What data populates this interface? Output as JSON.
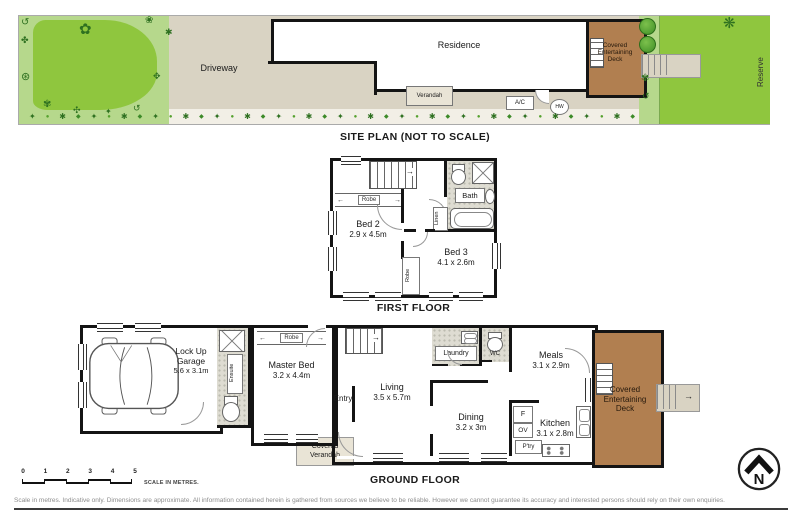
{
  "colors": {
    "lawn": "#8fc63e",
    "garden": "#b6d88c",
    "paving": "#d9d3c3",
    "deck": "#b17f50",
    "wall": "#141414",
    "tile": "#dedcd2",
    "porch": "#e9e4d6"
  },
  "icons": {
    "arrow_left": "←",
    "arrow_right": "→",
    "up_arrow": "↑",
    "down_arrow": "↓",
    "step_arrow": "→"
  },
  "site": {
    "title": "SITE PLAN (NOT TO SCALE)",
    "driveway": "Driveway",
    "residence": "Residence",
    "verandah": "Verandah",
    "deck": "Covered Entertaining Deck",
    "reserve": "Reserve",
    "ac": "A/C",
    "hw": "HW"
  },
  "ff": {
    "title": "FIRST FLOOR",
    "bed2": {
      "name": "Bed 2",
      "dims": "2.9 x 4.5m"
    },
    "bed3": {
      "name": "Bed 3",
      "dims": "4.1 x 2.6m"
    },
    "bath": "Bath",
    "linen": "Linen",
    "robe": "Robe"
  },
  "gf": {
    "title": "GROUND FLOOR",
    "garage": {
      "name": "Lock Up Garage",
      "dims": "5.6 x 3.1m"
    },
    "master": {
      "name": "Master Bed",
      "dims": "3.2 x 4.4m"
    },
    "living": {
      "name": "Living",
      "dims": "3.5 x 5.7m"
    },
    "dining": {
      "name": "Dining",
      "dims": "3.2 x 3m"
    },
    "kitchen": {
      "name": "Kitchen",
      "dims": "3.1 x 2.8m"
    },
    "meals": {
      "name": "Meals",
      "dims": "3.1 x 2.9m"
    },
    "laundry": "Laundry",
    "wc": "WC",
    "ensuite": "Ensuite",
    "entry": "Entry",
    "robe": "Robe",
    "verandah": "Covered Verandah",
    "deck": "Covered Entertaining Deck",
    "fridge": "F",
    "oven": "OV",
    "pantry": "P'try"
  },
  "scale": {
    "numbers": [
      "0",
      "1",
      "2",
      "3",
      "4",
      "5"
    ],
    "caption": "SCALE IN METRES."
  },
  "compass": {
    "north": "N"
  },
  "footer": {
    "disclaimer": "Scale in metres. Indicative only. Dimensions are approximate. All information contained herein is gathered from sources we believe to be reliable. However we cannot guarantee its accuracy and interested persons should rely on their own enquiries."
  },
  "decor": {
    "plant_row_count": 40,
    "plant_glyphs": [
      "✦",
      "●",
      "✱",
      "◆"
    ],
    "plant_colors": [
      "#2e7020",
      "#55a12e",
      "#2e7020",
      "#3c8a28"
    ],
    "site_plants": [
      {
        "t": "g",
        "x": 2,
        "y": 2,
        "g": "↺",
        "s": 10
      },
      {
        "t": "g",
        "x": 2,
        "y": 20,
        "g": "✤",
        "s": 9
      },
      {
        "t": "g",
        "x": 60,
        "y": 6,
        "g": "✿",
        "s": 15
      },
      {
        "t": "g",
        "x": 126,
        "y": 0,
        "g": "❀",
        "s": 10
      },
      {
        "t": "g",
        "x": 2,
        "y": 56,
        "g": "⊛",
        "s": 11
      },
      {
        "t": "g",
        "x": 24,
        "y": 84,
        "g": "✾",
        "s": 10
      },
      {
        "t": "g",
        "x": 54,
        "y": 90,
        "g": "✣",
        "s": 9
      },
      {
        "t": "g",
        "x": 86,
        "y": 92,
        "g": "✦",
        "s": 8
      },
      {
        "t": "g",
        "x": 114,
        "y": 88,
        "g": "↺",
        "s": 9
      },
      {
        "t": "g",
        "x": 134,
        "y": 56,
        "g": "✥",
        "s": 9
      },
      {
        "t": "g",
        "x": 146,
        "y": 12,
        "g": "✱",
        "s": 9
      },
      {
        "t": "tree",
        "x": 620,
        "y": 2,
        "s": 15
      },
      {
        "t": "tree",
        "x": 620,
        "y": 20,
        "s": 15
      },
      {
        "t": "g",
        "x": 622,
        "y": 58,
        "g": "✾",
        "s": 10
      },
      {
        "t": "g",
        "x": 623,
        "y": 76,
        "g": "↺",
        "s": 9
      },
      {
        "t": "g",
        "x": 704,
        "y": 0,
        "g": "❋",
        "s": 15
      }
    ]
  }
}
